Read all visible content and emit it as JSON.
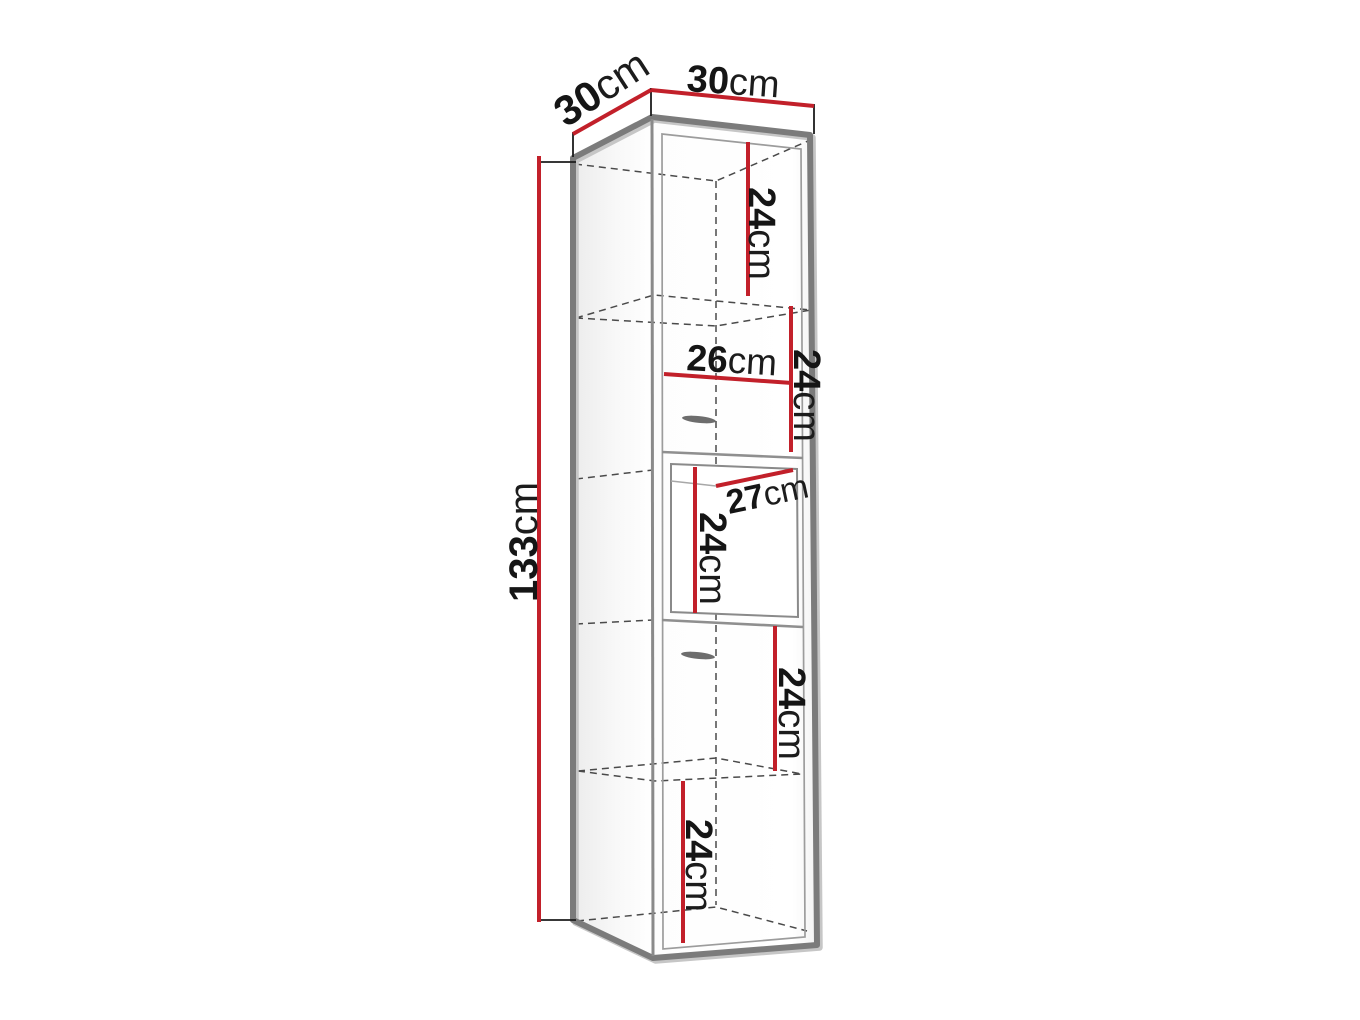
{
  "page": {
    "background": "#ffffff",
    "description": "3D line drawing of a tall wall cabinet with red dimension lines"
  },
  "colors": {
    "dimension_line_red": "#c2202a",
    "outline_gray": "#7b7b7b",
    "dashed_interior_gray": "#4a4a4a",
    "label_black": "#151515"
  },
  "dimensions": {
    "top_depth": {
      "value": "30",
      "unit": "cm"
    },
    "top_width": {
      "value": "30",
      "unit": "cm"
    },
    "total_height": {
      "value": "133",
      "unit": "cm"
    },
    "section_1_height": {
      "value": "24",
      "unit": "cm"
    },
    "drawer_width": {
      "value": "26",
      "unit": "cm"
    },
    "section_2_height": {
      "value": "24",
      "unit": "cm"
    },
    "niche_depth": {
      "value": "27",
      "unit": "cm"
    },
    "niche_height": {
      "value": "24",
      "unit": "cm"
    },
    "section_4_height": {
      "value": "24",
      "unit": "cm"
    },
    "section_5_height": {
      "value": "24",
      "unit": "cm"
    }
  }
}
